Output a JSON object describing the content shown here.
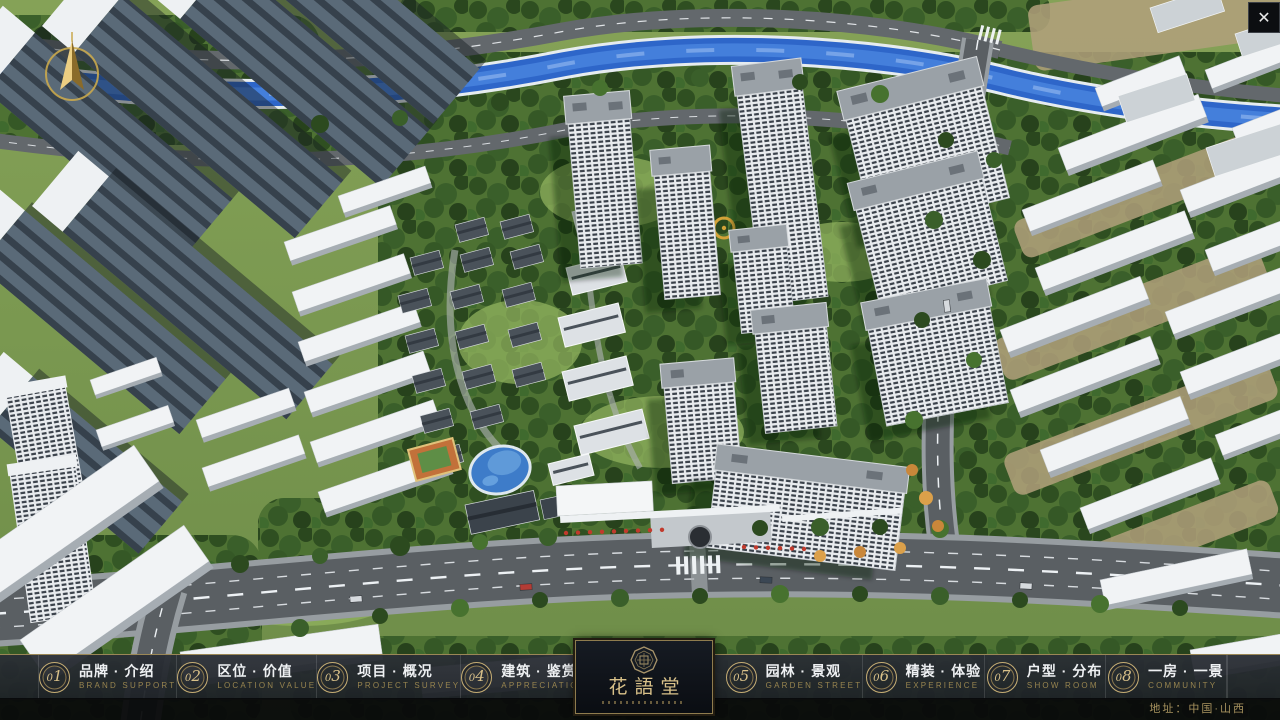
{
  "menu": {
    "items": [
      {
        "num": "01",
        "label": "品牌 · 介绍",
        "sublabel": "BRAND SUPPORT"
      },
      {
        "num": "02",
        "label": "区位 · 价值",
        "sublabel": "LOCATION VALUE"
      },
      {
        "num": "03",
        "label": "项目 · 概况",
        "sublabel": "PROJECT SURVEY"
      },
      {
        "num": "04",
        "label": "建筑 · 鉴赏",
        "sublabel": "APPRECIATION"
      },
      {
        "num": "05",
        "label": "园林 · 景观",
        "sublabel": "GARDEN STREET"
      },
      {
        "num": "06",
        "label": "精装 · 体验",
        "sublabel": "EXPERIENCE"
      },
      {
        "num": "07",
        "label": "户型 · 分布",
        "sublabel": "SHOW ROOM"
      },
      {
        "num": "08",
        "label": "一房 · 一景",
        "sublabel": "COMMUNITY"
      }
    ]
  },
  "logo": {
    "title": "花語堂"
  },
  "footer": {
    "address": "地址：中国·山西"
  },
  "icons": {
    "close": "✕",
    "compass": "north-arrow"
  },
  "colors": {
    "gold": "#c5ad74",
    "bar_bg": "#22262c",
    "river": "#2e66c9",
    "grass": "#789a4e"
  }
}
